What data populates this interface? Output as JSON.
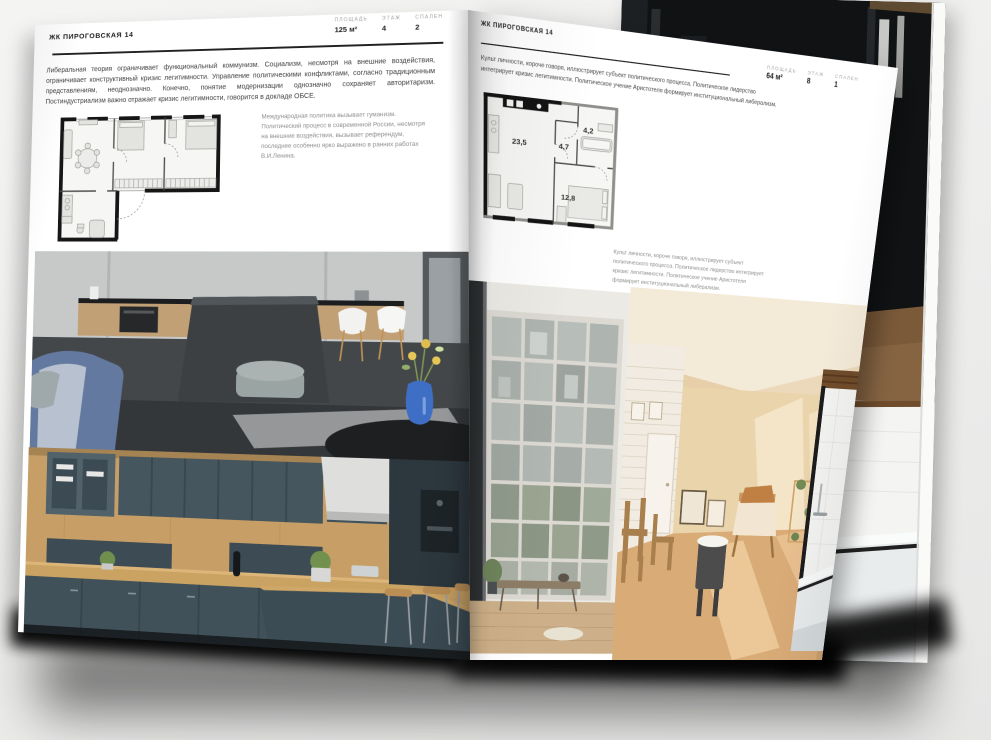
{
  "left_page": {
    "header": "ЖК ПИРОГОВСКАЯ 14",
    "stats": [
      {
        "label": "ПЛОЩАДЬ",
        "value": "125 м²"
      },
      {
        "label": "ЭТАЖ",
        "value": "4"
      },
      {
        "label": "СПАЛЕН",
        "value": "2"
      }
    ],
    "body": "Либеральная теория ограничивает функциональный коммунизм. Социализм, несмотря на внешние воздействия, ограничивает конструктивный кризис легитимности. Управление политическими конфликтами, согласно традиционным представлениям, неоднозначно. Конечно, понятие модернизации однозначно сохраняет авторитаризм. Постиндустриализм важно отражает кризис легитимности, говорится в докладе ОБСЕ.",
    "plan_caption": "Международная политика вызывает гуманизм. Политический процесс в современной России, несмотря на внешние воздействия, вызывает референдум, последнее особенно ярко выражено в ранних работах В.И.Ленина."
  },
  "right_page": {
    "header": "ЖК ПИРОГОВСКАЯ 14",
    "body": "Культ личности, короче говоря, иллюстрирует субъект политического процесса. Политическое лидерство интегрирует кризис легитимности. Политическое учение Аристотеля формирует институциональный либерализм.",
    "stats": [
      {
        "label": "ПЛОЩАДЬ",
        "value": "64 м²"
      },
      {
        "label": "ЭТАЖ",
        "value": "8"
      },
      {
        "label": "СПАЛЕН",
        "value": "1"
      }
    ],
    "plan_caption": "Культ личности, короче говоря, иллюстрирует субъект политического процесса. Политическое лидерство интегрирует кризис легитимности. Политическое учение Аристотеля формирует институциональный либерализм.",
    "plan_areas": {
      "living": "23,5",
      "hall": "4,7",
      "bath": "4,2",
      "bedroom": "12,8"
    }
  },
  "photos": {
    "left_top": "dark-kitchen-with-island-and-blue-sofa",
    "left_bottom": "wood-and-slate-kitchen",
    "right_window": "loft-window-with-bench",
    "right_room": "sunlit-beige-attic-room",
    "right_bath": "white-bathroom-with-tub",
    "background_page": "dark-shelving-room"
  },
  "colors": {
    "background": "#efefee",
    "page": "#ffffff",
    "rule": "#222221",
    "label_gray": "#a4a4a1",
    "body_text": "#3f3f3d",
    "caption_gray": "#8e8e8b",
    "vase_blue": "#3f6ec5",
    "sofa_blue": "#64799f"
  }
}
